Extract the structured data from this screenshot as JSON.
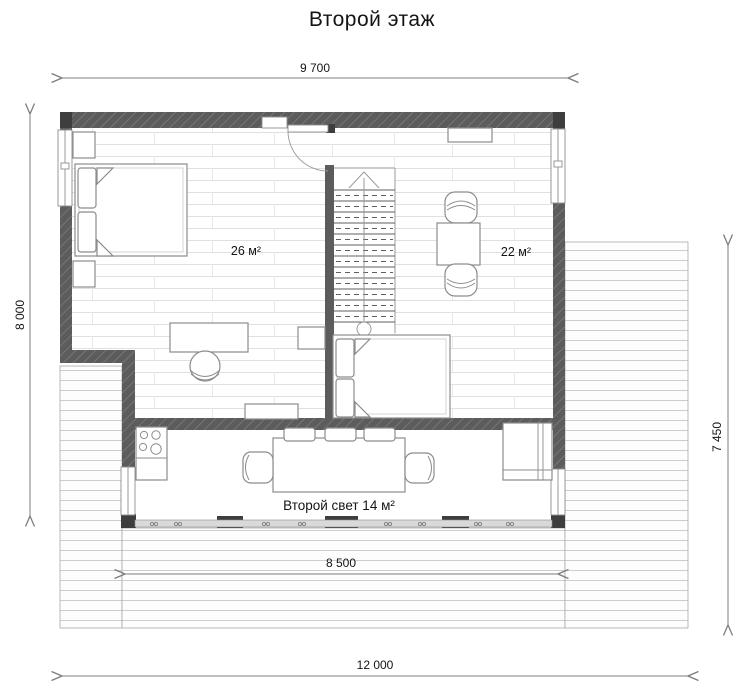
{
  "title": "Второй этаж",
  "rooms": {
    "bedroom": {
      "area_label": "26 м²"
    },
    "hall": {
      "area_label": "22 м²"
    },
    "void": {
      "area_label": "Второй свет 14 м²"
    }
  },
  "dimensions": {
    "top": "9 700",
    "left": "8 000",
    "right": "7 450",
    "terrace_inner": "8 500",
    "bottom": "12 000"
  },
  "colors": {
    "wall": "#5c5c5c",
    "post": "#3e3e3e",
    "furn_line": "#8c8c8c",
    "floor_line": "#e0e0e0",
    "deck_line": "#cdcdcd",
    "dim": "#7d7d7d",
    "text": "#141414"
  }
}
